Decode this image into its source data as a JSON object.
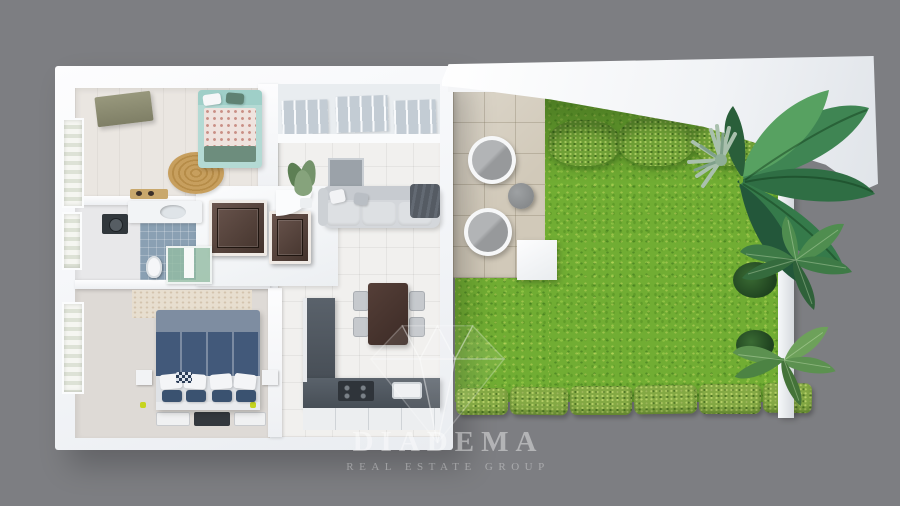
{
  "watermark": {
    "brand": "DIADEMA",
    "tagline": "REAL ESTATE GROUP",
    "logo": "diamond-gem-icon",
    "text_color": "rgba(255,255,255,0.42)"
  },
  "scene": {
    "view": "top-down 3D floor plan render of an apartment with terrace and walled garden",
    "background_color": "#7d7e82",
    "apartment": {
      "rooms": [
        {
          "name": "kids-bedroom",
          "items": [
            "mint-bed",
            "wardrobe",
            "round-jute-rug",
            "bench",
            "window"
          ]
        },
        {
          "name": "bathroom",
          "items": [
            "sink-counter",
            "washing-machine",
            "toilet",
            "glass-shower",
            "blue-mosaic-floor",
            "window"
          ]
        },
        {
          "name": "master-bedroom",
          "items": [
            "navy-double-bed",
            "white-pillows",
            "nightstands",
            "runner-rugs",
            "accent-wall",
            "window"
          ]
        },
        {
          "name": "hallway",
          "items": [
            "wood-door",
            "wood-door",
            "planter"
          ]
        },
        {
          "name": "living-room",
          "items": [
            "sofa",
            "tv-panel",
            "potted-plant",
            "window-wall",
            "console"
          ]
        },
        {
          "name": "kitchen-dining",
          "items": [
            "dining-table",
            "four-chairs",
            "l-shaped-counter",
            "sink",
            "cooktop",
            "cabinets"
          ]
        }
      ]
    },
    "terrace": {
      "floor": "beige-stone-tiles",
      "items": [
        "lounge-chair",
        "lounge-chair",
        "round-side-table"
      ]
    },
    "garden": {
      "items": [
        "lawn",
        "top-hedges",
        "bottom-hedge-row",
        "banana-plant",
        "agave-plant",
        "palm-fronds",
        "palm-fronds",
        "boundary-wall",
        "roof-canopy"
      ]
    }
  },
  "palette": {
    "background": "#7d7e82",
    "walls": "#f8f9fb",
    "grass": "#71ad33",
    "hedge": "#84a944",
    "terrace_tile": "#d1c9b9",
    "bathroom_tile": "#8aa0b3",
    "kitchen_counter": "#525a62",
    "dining_table": "#47332d",
    "bed_navy": "#42597a",
    "bed_mint": "#b4dad4",
    "sofa_gray": "#d4d7db"
  }
}
